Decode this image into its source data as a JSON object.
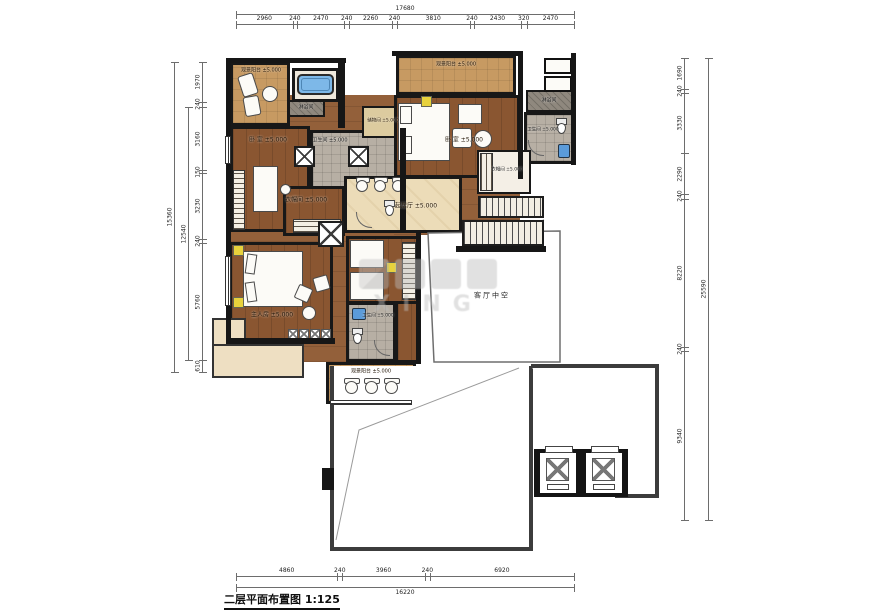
{
  "title": {
    "text": "二层平面布置图 1:125"
  },
  "watermark": {
    "latin": "XING"
  },
  "dims": {
    "top": {
      "total": "17680",
      "segments": [
        "2960",
        "240",
        "2470",
        "240",
        "2260",
        "240",
        "3810",
        "240",
        "2430",
        "320",
        "2470"
      ]
    },
    "bottom": {
      "total": "16220",
      "segments": [
        "4860",
        "240",
        "3960",
        "240",
        "6920"
      ]
    },
    "left": {
      "outer_total": "15360",
      "inner_total": "12540",
      "segments": [
        "1970",
        "240",
        "3160",
        "150",
        "3230",
        "240",
        "5760",
        "610"
      ]
    },
    "right": {
      "total": "25590",
      "segments": [
        "1690",
        "240",
        "3330",
        "2290",
        "240",
        "8220",
        "240",
        "9340"
      ]
    }
  },
  "rooms": {
    "balcony_tl": {
      "label": "观景阳台 ±5.000"
    },
    "shower_tl": {
      "label": "淋浴间"
    },
    "bedroom_tl": {
      "label": "卧 室 ±5.000"
    },
    "bath_center": {
      "label": "卫生间 ±5.000"
    },
    "storage": {
      "label": "储物间 ±5.000"
    },
    "balcony_top": {
      "label": "观景阳台 ±5.000"
    },
    "bedroom_tr": {
      "label": "卧 室 ±5.000"
    },
    "shower_tr": {
      "label": "淋浴间"
    },
    "bath_tr": {
      "label": "卫生间 ±5.000"
    },
    "closet_r": {
      "label": "衣帽间 ±5.000"
    },
    "living": {
      "label": "起居厅 ±5.000"
    },
    "closet_l": {
      "label": "衣帽间 ±5.000"
    },
    "master": {
      "label": "主人房 ±5.000"
    },
    "bedroom2_bath": {
      "label": "卫生间 ±5.000"
    },
    "balcony_b": {
      "label": "观景阳台 ±5.000"
    },
    "void": {
      "label": "客厅中空"
    }
  },
  "colors": {
    "wood_floor": "#8a5631",
    "balcony_tile": "#c79a62",
    "marble": "#ecdcb8",
    "bath_tile": "#b7afa4",
    "wall": "#161616",
    "bathtub": "#7db8e8",
    "accent_yellow": "#e8d23c",
    "dimension": "#6d6d6d"
  }
}
